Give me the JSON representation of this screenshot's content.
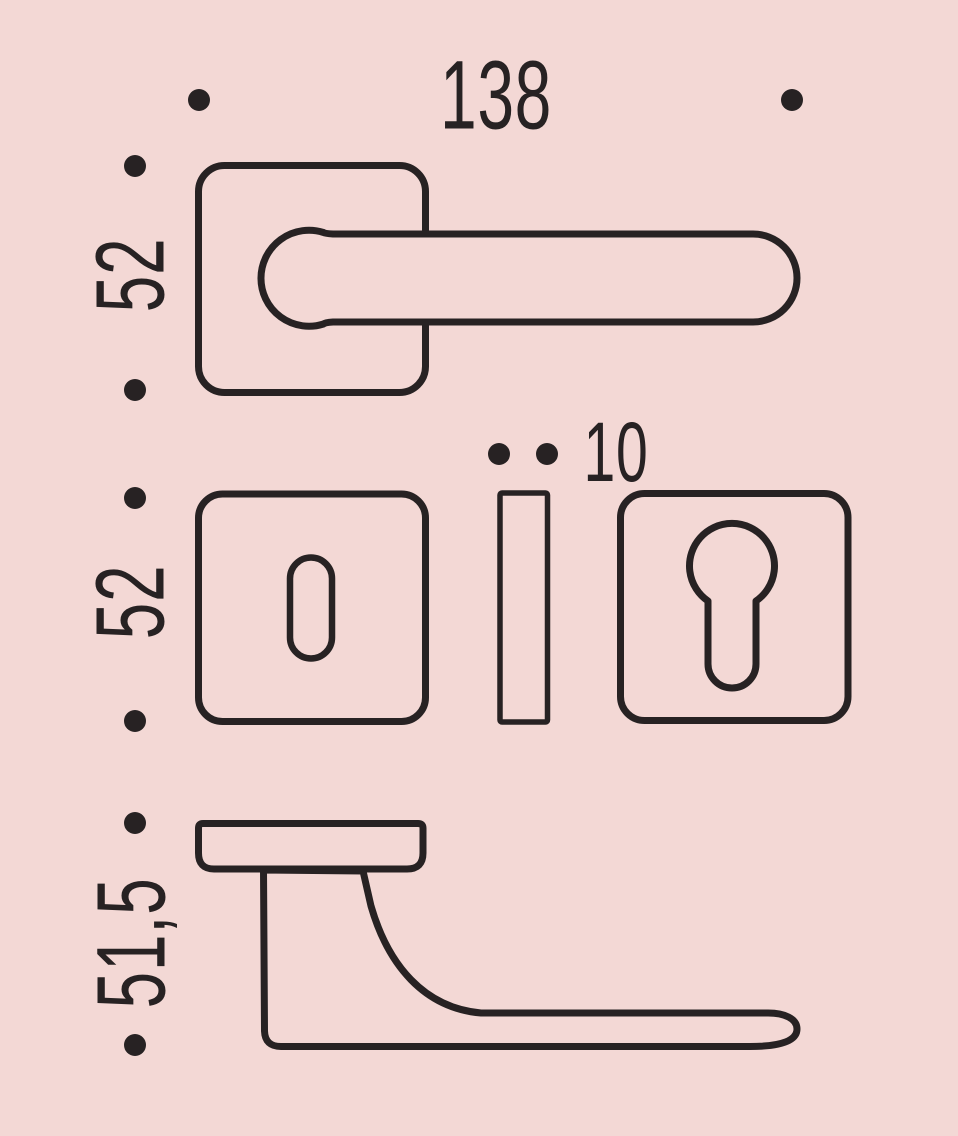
{
  "drawing": {
    "background_color": "#f3d8d5",
    "ink_color": "#272223",
    "dimensions": {
      "top_length": "138",
      "top_rosette_height": "52",
      "escutcheon_height": "52",
      "escutcheon_thickness": "10",
      "side_projection": "51,5"
    }
  }
}
